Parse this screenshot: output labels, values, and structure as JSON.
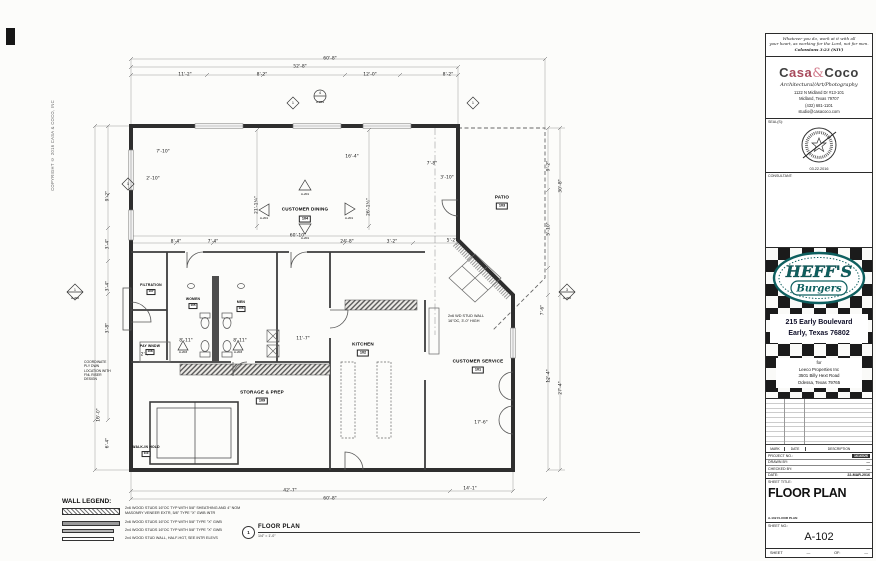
{
  "page": {
    "copyright": "COPYRIGHT © 2016 CASA & COCO, INC"
  },
  "titleblock": {
    "verse": {
      "line1": "Whatever you do, work at it with all",
      "line2": "your heart, as working for the Lord, not for men.",
      "ref": "Colossians 3:23 (NIV)"
    },
    "firm": {
      "brand_c": "C",
      "brand_asa": "asa",
      "amp": "&",
      "brand_coco": "Coco",
      "tagline": "Architectural/Art/Photography",
      "addr1": "1122 N Midland Dr #13-101",
      "addr2": "Midland, Texas 79707",
      "phone": "(432) 681-1101",
      "email": "studio@casacoco.com"
    },
    "seal": {
      "label": "SEAL(S):",
      "date": "03.22.2016"
    },
    "consultant_label": "CONSULTANT:",
    "heffs": {
      "name": "HEFF'S",
      "sub": "Burgers",
      "addr1": "215 Early Boulevard",
      "addr2": "Early, Texas 76802",
      "for": "for",
      "client1": "Leeco Properties Inc",
      "client2": "3501 Billy Hext Road",
      "client3": "Odessa, Texas 79765"
    },
    "revisions": {
      "mark": "MARK",
      "date": "DATE",
      "description": "DESCRIPTION"
    },
    "info": [
      {
        "label": "PROJECT NO.:",
        "value": "1616026"
      },
      {
        "label": "DRAWN BY:",
        "value": "—"
      },
      {
        "label": "CHECKED BY:",
        "value": "—"
      },
      {
        "label": "DATE:",
        "value": "22-MAR-2016"
      }
    ],
    "sheet": {
      "title_label": "SHEET TITLE:",
      "title": "FLOOR PLAN",
      "file_ref": "A-102 FLOOR PLAN",
      "no_label": "SHEET NO.:",
      "no": "A-102",
      "foot_sheet": "SHEET",
      "foot_of": "OF:",
      "dash": "—"
    }
  },
  "plan": {
    "rooms": [
      {
        "name": "CUSTOMER DINING",
        "number": "104"
      },
      {
        "name": "PATIO",
        "number": "103"
      },
      {
        "name": "FILTRATION",
        "number": "107"
      },
      {
        "name": "WOMEN",
        "number": "105"
      },
      {
        "name": "MEN",
        "number": "106"
      },
      {
        "name": "STORAGE & PREP",
        "number": "109"
      },
      {
        "name": "KITCHEN",
        "number": "102"
      },
      {
        "name": "CUSTOMER SERVICE",
        "number": "101"
      },
      {
        "name": "PAY WNDW",
        "number": "108"
      },
      {
        "name": "WALK-IN HOLD",
        "number": "110"
      }
    ],
    "dims": [
      "60'-8\"",
      "52'-8\"",
      "11'-2\"",
      "8'-2\"",
      "12'-0\"",
      "8'-2\"",
      "9'-2\"",
      "3'-4\"",
      "3'-4\"",
      "3'-8\"",
      "16'-0\"",
      "6'-4\"",
      "30'-8\"",
      "9'-2\"",
      "5'-10\"",
      "27'-4\"",
      "12'-4\"",
      "7'-6\"",
      "42'-7\"",
      "60'-8\"",
      "14'-1\"",
      "21'-1¼\"",
      "26'-1½\"",
      "60'-10\"",
      "8'-4\"",
      "7'-4\"",
      "24'-8\"",
      "3'-2\"",
      "11'-7\"",
      "17'-6\"",
      "7'-8\"",
      "3'-10\"",
      "5'-2\"",
      "16'-4\"",
      "7'-10\"",
      "2'-10\"",
      "2'-7\"",
      "8'-11\"",
      "8'-11\""
    ],
    "notes": [
      "2x6 WD STUD WALL\n16\"OC, 3'-0\" HIGH",
      "COORDINATE\nPLY DWN\nLOCATION WITH\nFNL RISER\nDESIGN"
    ],
    "markers": [
      {
        "num": "4",
        "ref": "A-201"
      },
      {
        "ref": "A-201"
      },
      {
        "ref": "A-201"
      },
      {
        "ref": "A-201"
      },
      {
        "ref": "A-201"
      },
      {
        "num": "1",
        "ref": "A-202"
      },
      {
        "num": "3",
        "ref": "A-202"
      },
      {
        "ref": "A-203"
      },
      {
        "ref": "A-203"
      }
    ],
    "window_tag": "1",
    "legend": {
      "title": "WALL LEGEND:",
      "items": [
        "2x6 WOOD STUDS 16\"OC TYP WITH 5/8\" SHEATHING AND 4\" NOM\nMASONRY VENEER EXTR, 5/8\" TYPE \"X\" GWB INTR",
        "2x6 WOOD STUDS 16\"OC TYP WITH 5/8\" TYPE \"X\" GWB",
        "2x4 WOOD STUDS 16\"OC TYP WITH 5/8\" TYPE \"X\" GWB",
        "2x4 WOOD STUD WALL, HALF-HGT, SEE INTR ELEVS"
      ]
    },
    "drawing_title": {
      "number": "1",
      "title": "FLOOR PLAN",
      "scale": "1/4\" = 1'-0\""
    }
  }
}
